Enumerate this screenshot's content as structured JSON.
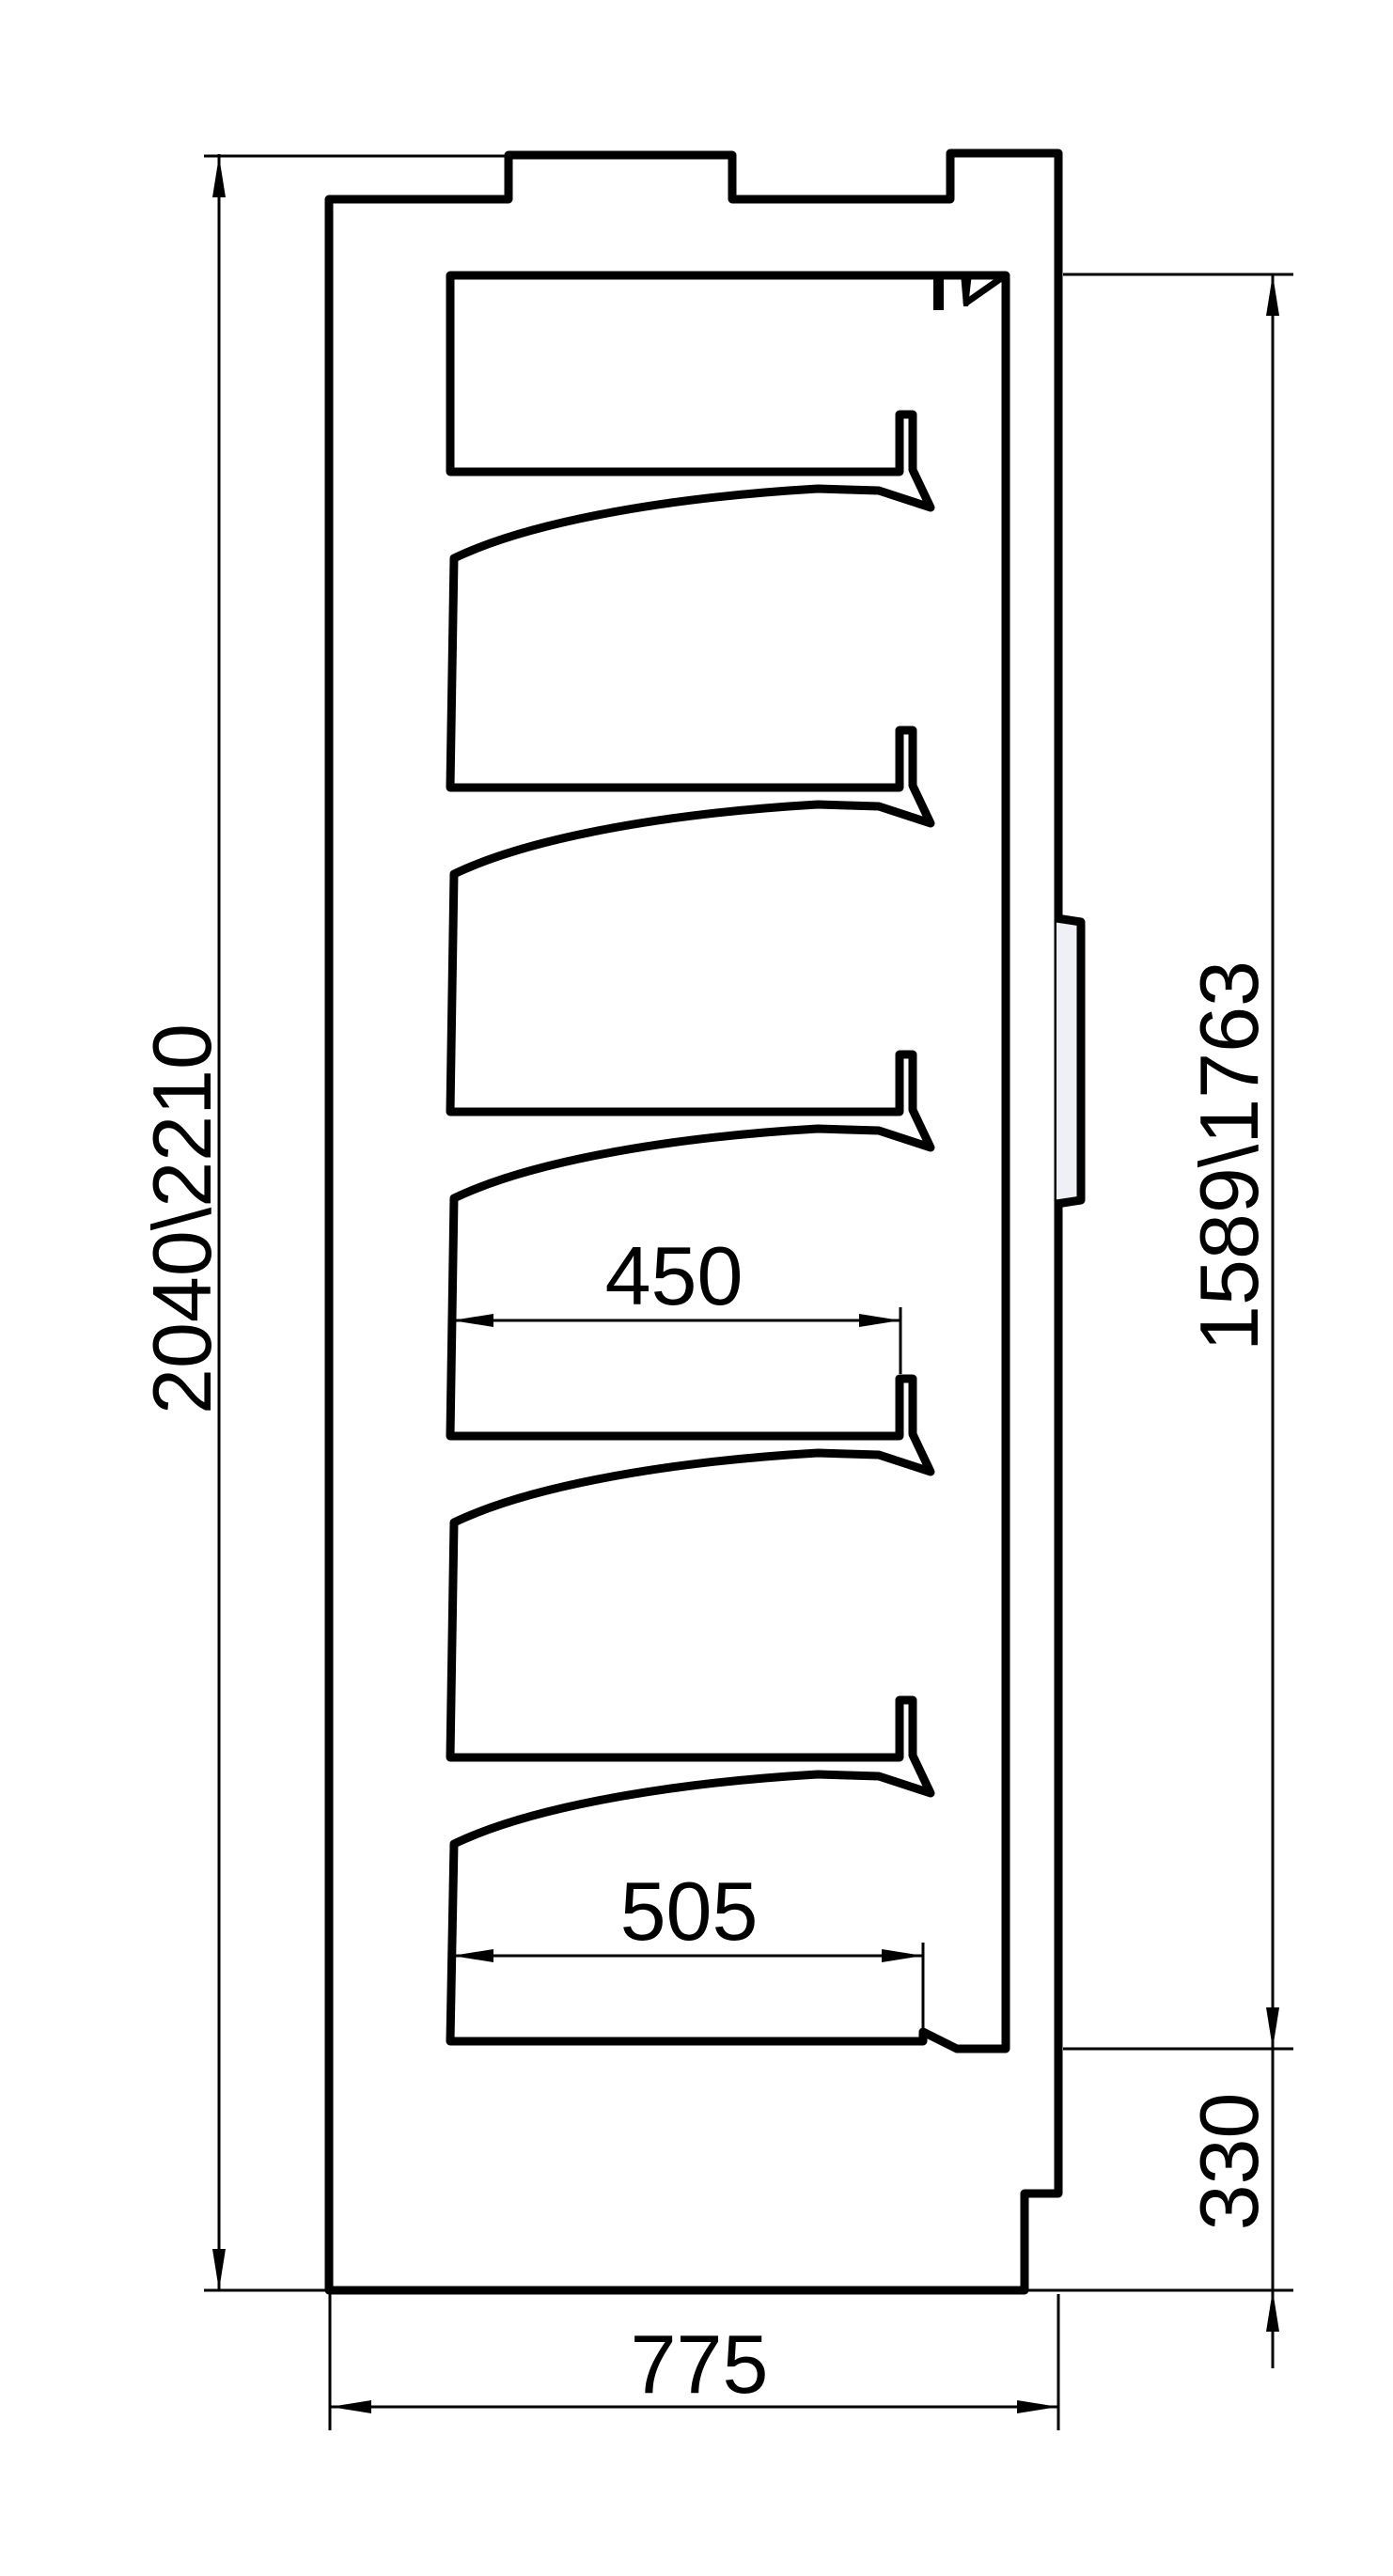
{
  "drawing": {
    "description": "Side cross-section of shelving unit",
    "dimensions": {
      "overall_height": "2040\\2210",
      "interior_back_height": "1589\\1763",
      "upper_shelf_depth": "450",
      "bottom_shelf_depth": "505",
      "base_height": "330",
      "overall_depth": "775"
    },
    "colors": {
      "body_fill": "#c6cad4",
      "bump_fill": "#eef0f5",
      "outline": "#000000",
      "dimension_lines": "#000000",
      "background": "#ffffff"
    }
  }
}
